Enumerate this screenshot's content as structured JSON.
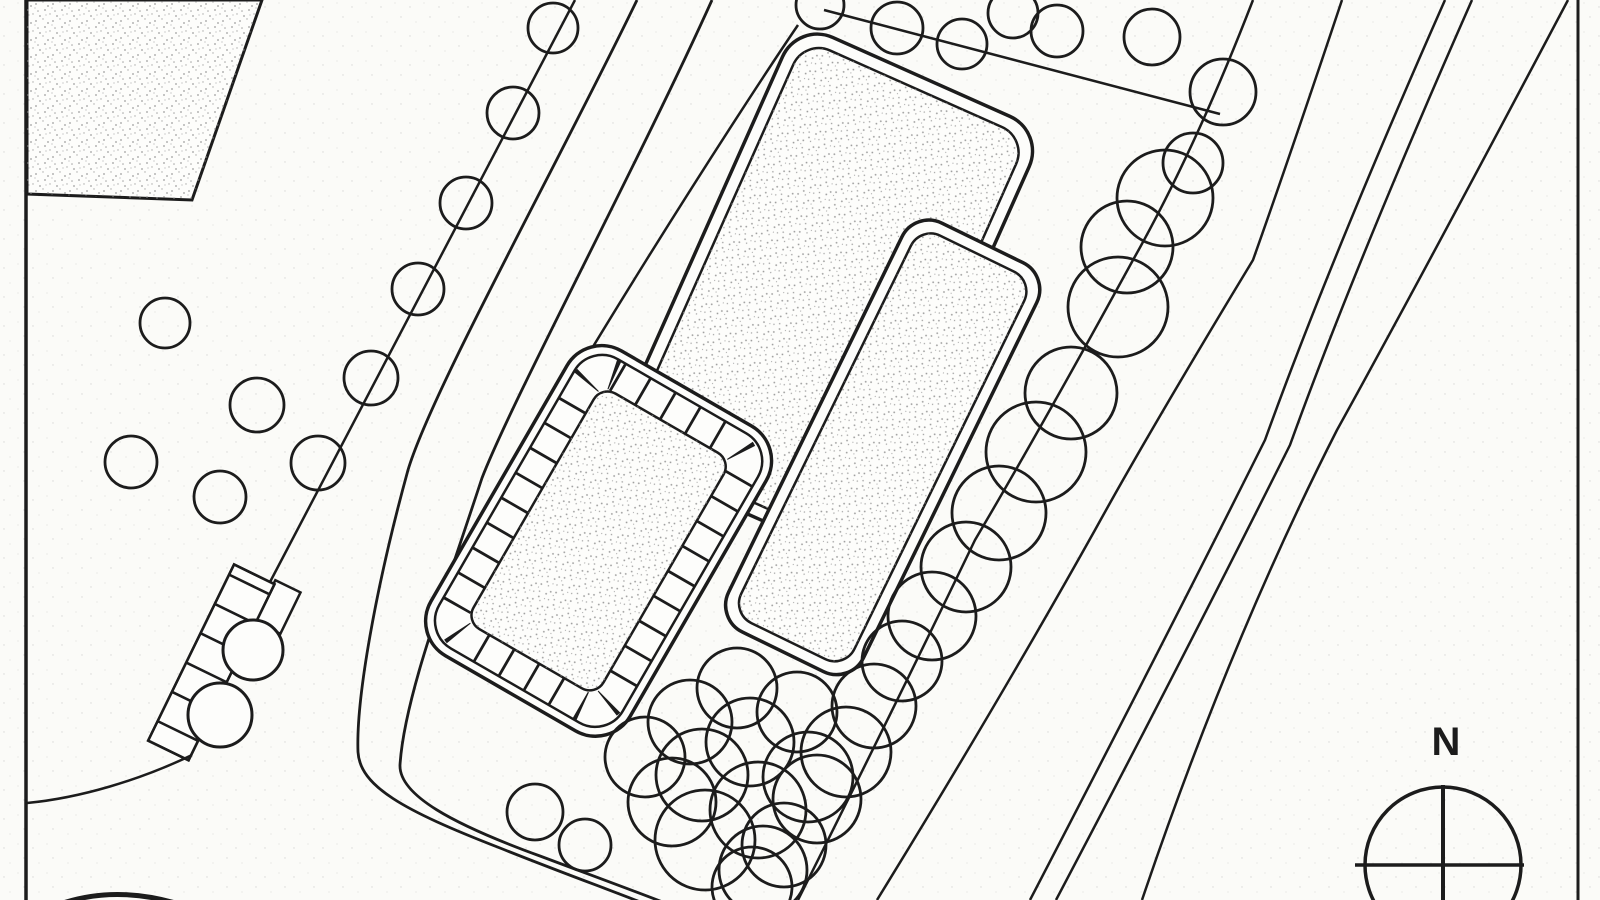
{
  "meta": {
    "drawing_type": "architectural-site-plan",
    "description": "Scanned black-ink site plan: three stippled buildings, tree rows, curved roads, north compass"
  },
  "colors": {
    "paper": "#fbfbf8",
    "ink": "#1c1c1c",
    "stipple": "#909090"
  },
  "compass": {
    "label": "N"
  },
  "elements": {
    "buildings": [
      "existing-building-northwest",
      "main-building",
      "tower-building",
      "courtyard-building"
    ],
    "landscape": [
      "fence-tree-row",
      "hedge-strip",
      "street-tree-chain",
      "tree-grove",
      "scattered-trees"
    ],
    "roads": [
      "access-road",
      "boulevard",
      "entry-curve"
    ]
  }
}
